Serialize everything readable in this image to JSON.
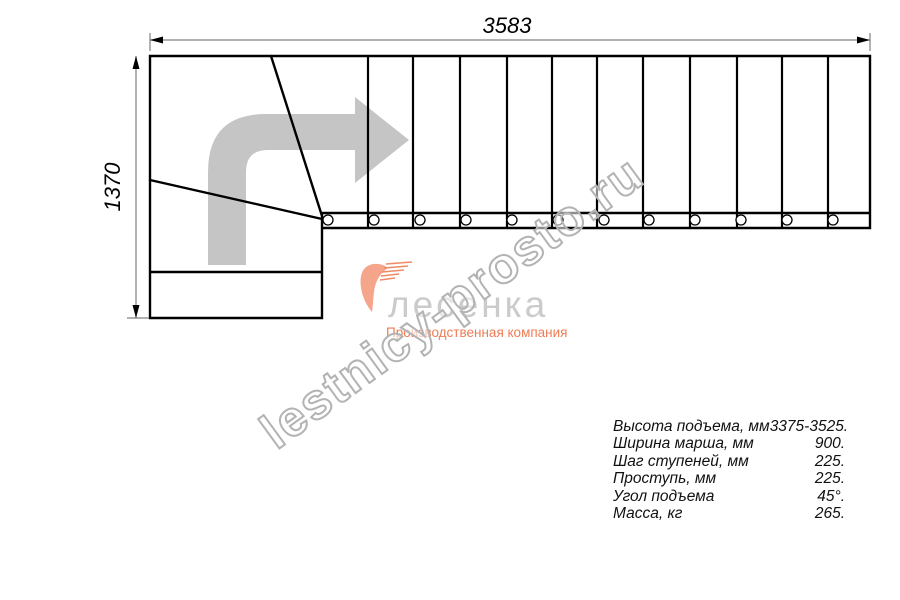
{
  "drawing": {
    "top_dimension_mm": "3583",
    "left_dimension_mm": "1370",
    "view": "staircase plan view, L-shaped with winder turn",
    "straight_treads": 12,
    "step_holes": 12
  },
  "logo": {
    "name": "лесенка",
    "tagline": "Производственная компания"
  },
  "watermark": {
    "text": "lestnicy-prosto.ru"
  },
  "specs": {
    "rows": [
      {
        "label": "Высота подъема, мм",
        "value": "3375-3525."
      },
      {
        "label": "Ширина марша, мм",
        "value": "900."
      },
      {
        "label": "Шаг ступеней, мм",
        "value": "225."
      },
      {
        "label": "Проступь, мм",
        "value": "225."
      },
      {
        "label": "Угол подъема",
        "value": "45°."
      },
      {
        "label": "Масса, кг",
        "value": "265."
      }
    ]
  },
  "colors": {
    "line_black": "#000000",
    "dimension_gray": "#808080",
    "arrow_gray": "#c5c5c5",
    "logo_gray": "#cbcbcb",
    "logo_accent": "#ee7c55",
    "watermark_outline": "#b3b3b3"
  }
}
